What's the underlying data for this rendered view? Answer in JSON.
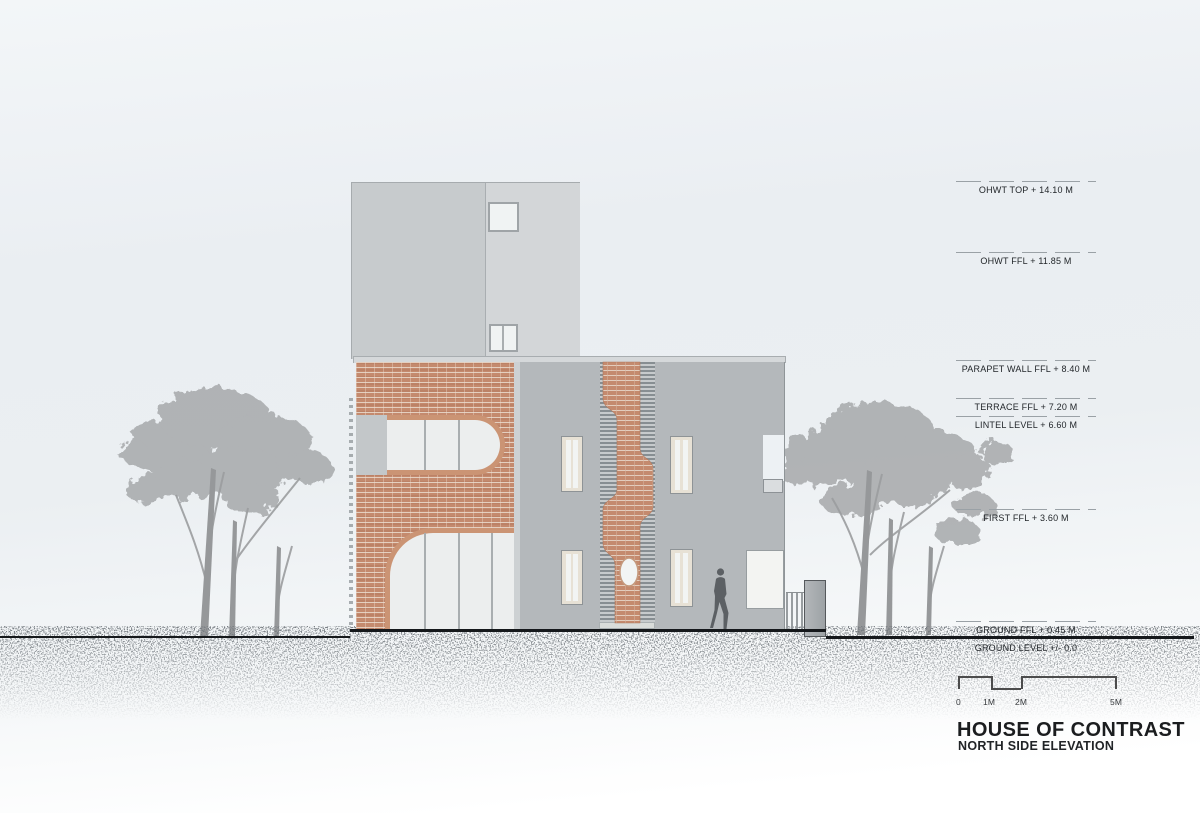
{
  "drawing": {
    "project_title": "HOUSE OF CONTRAST",
    "sheet_title": "NORTH SIDE ELEVATION"
  },
  "levels": [
    {
      "label": "OHWT TOP + 14.10 M"
    },
    {
      "label": "OHWT FFL + 11.85 M"
    },
    {
      "label": "PARAPET WALL FFL + 8.40 M"
    },
    {
      "label": "TERRACE FFL + 7.20 M"
    },
    {
      "label": "LINTEL LEVEL + 6.60 M"
    },
    {
      "label": "FIRST FFL + 3.60 M"
    },
    {
      "label": "GROUND FFL + 0.45 M"
    },
    {
      "label": "GROUND LEVEL +/- 0.0"
    }
  ],
  "scale_bar": {
    "labels": [
      "0",
      "1M",
      "2M",
      "5M"
    ]
  },
  "colors": {
    "brick": "#c48a6e",
    "facade_gray": "#b4b8bb",
    "tower_gray": "#d3d6d8",
    "louver_gray": "#878e92",
    "ground_line": "#15181b",
    "sky": "#ebeff2",
    "text": "#22262a"
  }
}
